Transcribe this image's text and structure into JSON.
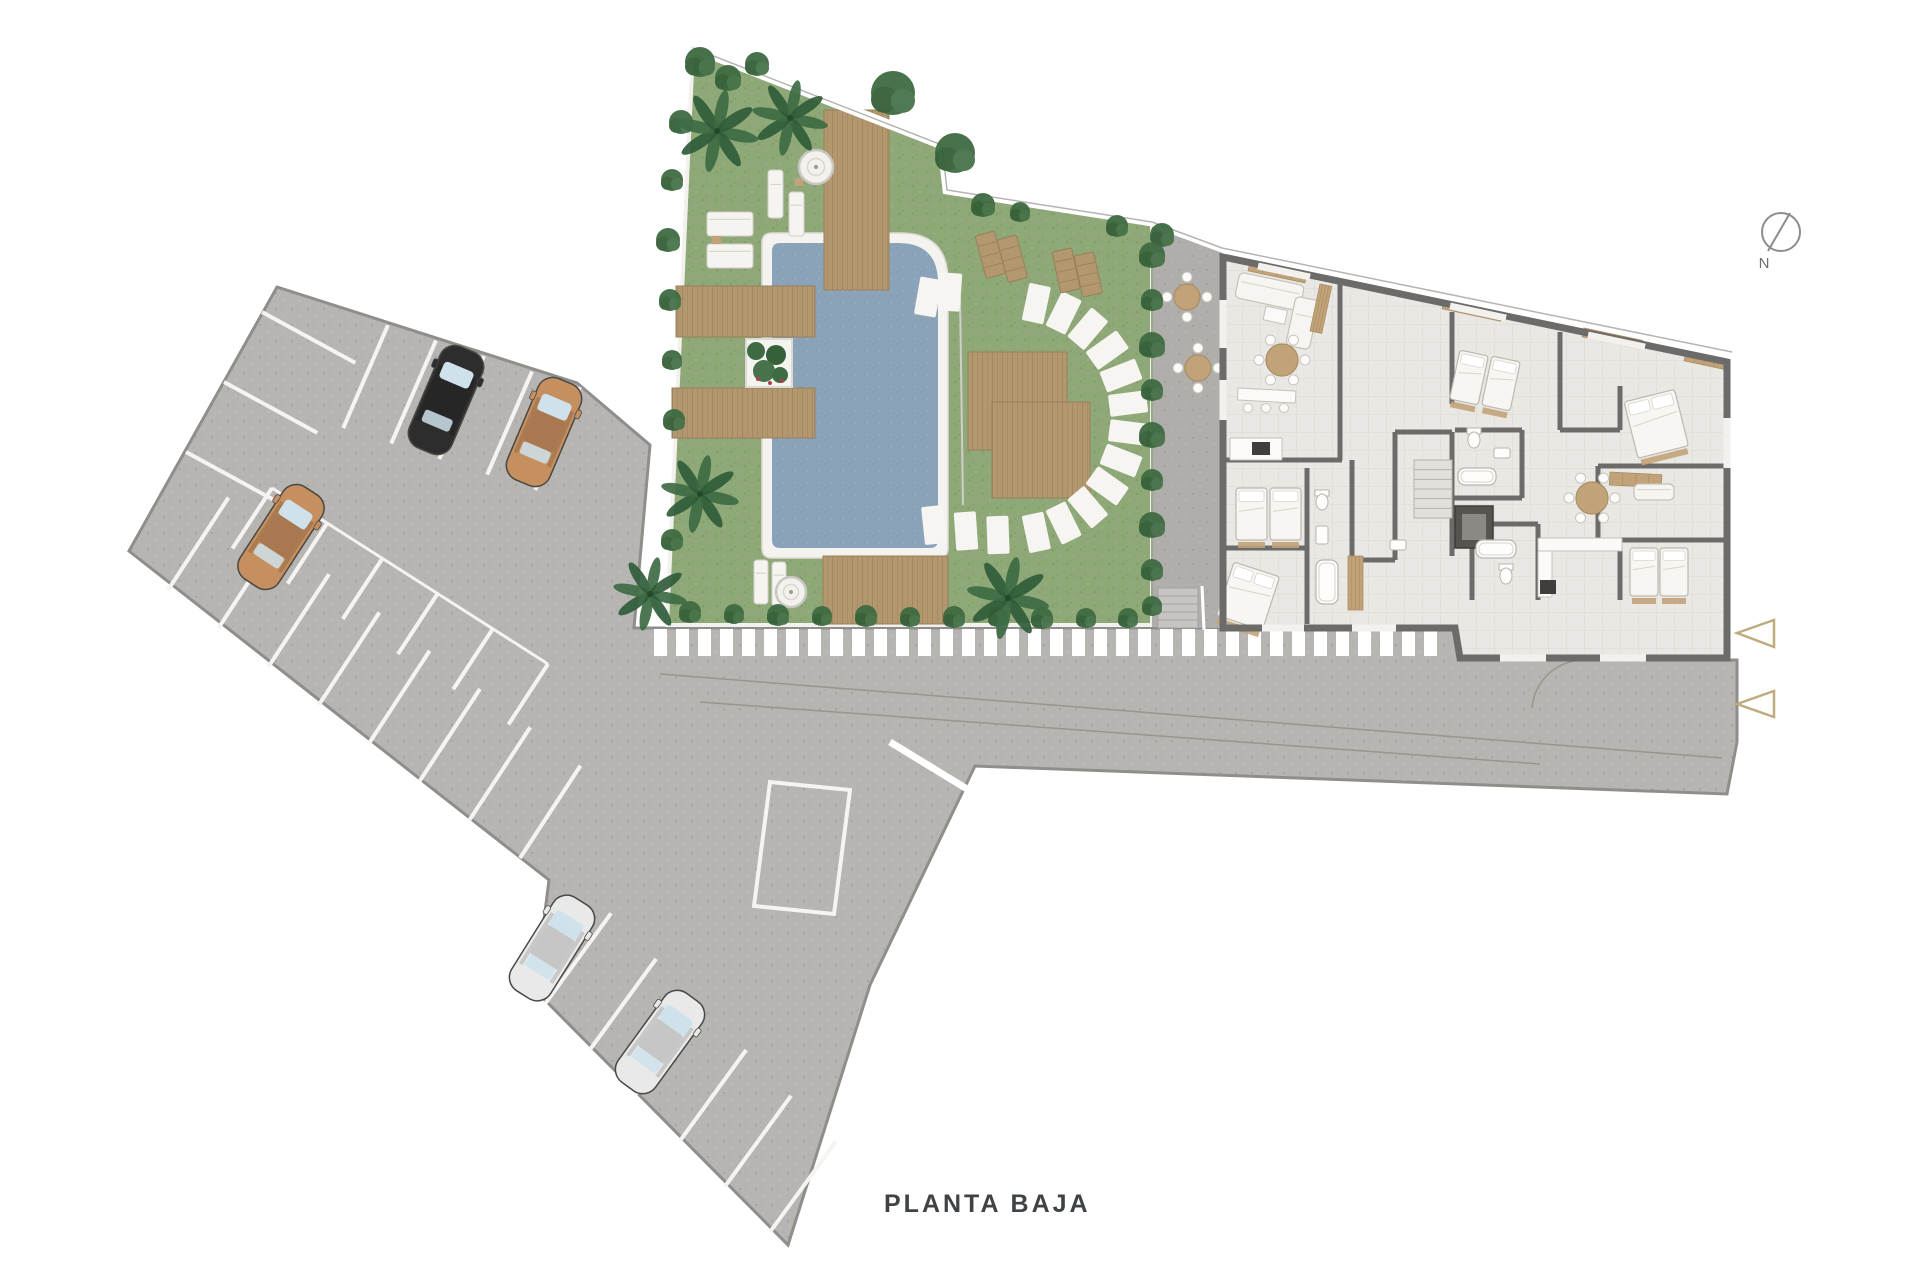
{
  "title": {
    "text": "PLANTA BAJA"
  },
  "compass": {
    "label": "N"
  },
  "palette": {
    "bg": "#ffffff",
    "pavement": "#b6b5b2",
    "pavement_dark": "#afaeab",
    "grass": "#8fa878",
    "bush": "#3f6b42",
    "wood": "#b3976e",
    "wood_line": "#97805a",
    "water": "#8aa3b8",
    "wall": "#6c6b69",
    "floor": "#e9e8e4",
    "floor_line": "#dbd9d2",
    "fixture": "#f7f6f3",
    "tan": "#c2a379",
    "accent": "#bfab7e",
    "text": "#3f4345",
    "stall": "#f5f4f1",
    "road_line": "#97968f",
    "glass": "#cfe2ec",
    "lot_edge": "#8f8e8b",
    "black_car": "#2d2d2d",
    "tan_car": "#c68f5f",
    "white_car": "#e9e9ea"
  },
  "parking": {
    "cars": [
      {
        "x": 446,
        "y": 400,
        "rot": 23,
        "color": "black_car"
      },
      {
        "x": 544,
        "y": 432,
        "rot": 23,
        "color": "tan_car"
      },
      {
        "x": 281,
        "y": 537,
        "rot": 33,
        "color": "tan_car"
      },
      {
        "x": 552,
        "y": 948,
        "rot": 32,
        "color": "white_car"
      },
      {
        "x": 660,
        "y": 1042,
        "rot": 36,
        "color": "white_car"
      }
    ],
    "stall_rows": [
      {
        "a": [
          388,
          325
        ],
        "b": [
          580,
          387
        ],
        "count": 5,
        "dir": [
          -0.4,
          0.92
        ],
        "len": 112
      },
      {
        "a": [
          262,
          312
        ],
        "b": [
          186,
          452
        ],
        "count": 3,
        "dir": [
          0.88,
          0.48
        ],
        "len": 106
      },
      {
        "a": [
          168,
          590
        ],
        "b": [
          520,
          858
        ],
        "count": 8,
        "dir": [
          0.55,
          -0.84
        ],
        "len": 110
      },
      {
        "a": [
          545,
          1004
        ],
        "b": [
          770,
          1232
        ],
        "count": 6,
        "dir": [
          0.59,
          -0.81
        ],
        "len": 112
      },
      {
        "a": [
          272,
          488
        ],
        "b": [
          548,
          664
        ],
        "count": 6,
        "dir": [
          -0.55,
          0.84
        ],
        "len": 72
      }
    ],
    "spine_rail": {
      "x1": 272,
      "y1": 488,
      "x2": 548,
      "y2": 664
    },
    "ramp_marking": "770,782 850,790 834,914 754,906"
  },
  "crosswalk": {
    "from": 654,
    "to": 1446,
    "y": 629,
    "h": 27,
    "w": 13,
    "gap": 9
  },
  "entrance_arrows": [
    "1737,633 1774,620 1774,647",
    "1737,704 1774,691 1774,717"
  ],
  "garden": {
    "palms": [
      {
        "x": 717,
        "y": 131,
        "r": 38
      },
      {
        "x": 790,
        "y": 118,
        "r": 35
      },
      {
        "x": 700,
        "y": 494,
        "r": 36
      },
      {
        "x": 650,
        "y": 594,
        "r": 34
      },
      {
        "x": 1008,
        "y": 598,
        "r": 38
      }
    ],
    "bushes": [
      {
        "x": 700,
        "y": 62,
        "r": 15
      },
      {
        "x": 728,
        "y": 78,
        "r": 13
      },
      {
        "x": 757,
        "y": 64,
        "r": 12
      },
      {
        "x": 681,
        "y": 122,
        "r": 12
      },
      {
        "x": 672,
        "y": 180,
        "r": 11
      },
      {
        "x": 668,
        "y": 240,
        "r": 12
      },
      {
        "x": 670,
        "y": 300,
        "r": 11
      },
      {
        "x": 672,
        "y": 360,
        "r": 10
      },
      {
        "x": 674,
        "y": 420,
        "r": 11
      },
      {
        "x": 672,
        "y": 540,
        "r": 11
      },
      {
        "x": 893,
        "y": 93,
        "r": 22
      },
      {
        "x": 955,
        "y": 153,
        "r": 20
      },
      {
        "x": 983,
        "y": 205,
        "r": 12
      },
      {
        "x": 1020,
        "y": 212,
        "r": 10
      },
      {
        "x": 1117,
        "y": 226,
        "r": 11
      },
      {
        "x": 1162,
        "y": 235,
        "r": 12
      },
      {
        "x": 690,
        "y": 612,
        "r": 11
      },
      {
        "x": 734,
        "y": 614,
        "r": 10
      },
      {
        "x": 778,
        "y": 615,
        "r": 11
      },
      {
        "x": 822,
        "y": 616,
        "r": 10
      },
      {
        "x": 866,
        "y": 616,
        "r": 11
      },
      {
        "x": 910,
        "y": 617,
        "r": 10
      },
      {
        "x": 954,
        "y": 617,
        "r": 11
      },
      {
        "x": 998,
        "y": 617,
        "r": 10
      },
      {
        "x": 1042,
        "y": 618,
        "r": 11
      },
      {
        "x": 1086,
        "y": 618,
        "r": 10
      },
      {
        "x": 1128,
        "y": 618,
        "r": 10
      },
      {
        "x": 1152,
        "y": 255,
        "r": 13
      },
      {
        "x": 1152,
        "y": 300,
        "r": 11
      },
      {
        "x": 1152,
        "y": 345,
        "r": 13
      },
      {
        "x": 1152,
        "y": 390,
        "r": 11
      },
      {
        "x": 1152,
        "y": 435,
        "r": 13
      },
      {
        "x": 1152,
        "y": 480,
        "r": 11
      },
      {
        "x": 1152,
        "y": 525,
        "r": 13
      },
      {
        "x": 1152,
        "y": 570,
        "r": 11
      },
      {
        "x": 1152,
        "y": 606,
        "r": 10
      }
    ],
    "decks": [
      {
        "x": 824,
        "y": 110,
        "w": 65,
        "h": 180
      },
      {
        "x": 676,
        "y": 286,
        "w": 139,
        "h": 51
      },
      {
        "x": 672,
        "y": 388,
        "w": 143,
        "h": 50
      },
      {
        "x": 968,
        "y": 352,
        "w": 99,
        "h": 98
      },
      {
        "x": 992,
        "y": 402,
        "w": 98,
        "h": 96
      },
      {
        "x": 823,
        "y": 556,
        "w": 125,
        "h": 68
      }
    ],
    "planter": {
      "x": 746,
      "y": 339,
      "w": 46,
      "h": 48
    },
    "white_loungers": [
      {
        "x": 707,
        "y": 212,
        "w": 46,
        "h": 24,
        "rot": 0
      },
      {
        "x": 707,
        "y": 244,
        "w": 46,
        "h": 24,
        "rot": 0
      },
      {
        "x": 768,
        "y": 170,
        "w": 15,
        "h": 48,
        "rot": 0
      },
      {
        "x": 789,
        "y": 192,
        "w": 15,
        "h": 44,
        "rot": 0
      },
      {
        "x": 754,
        "y": 560,
        "w": 14,
        "h": 44,
        "rot": 0
      },
      {
        "x": 772,
        "y": 562,
        "w": 14,
        "h": 44,
        "rot": 0
      }
    ],
    "wood_loungers": [
      {
        "x": 975,
        "y": 236,
        "w": 20,
        "h": 44,
        "rot": -15
      },
      {
        "x": 997,
        "y": 240,
        "w": 20,
        "h": 44,
        "rot": -15
      },
      {
        "x": 1052,
        "y": 252,
        "w": 20,
        "h": 42,
        "rot": -12
      },
      {
        "x": 1074,
        "y": 256,
        "w": 20,
        "h": 42,
        "rot": -12
      }
    ],
    "side_tables": [
      {
        "x": 712,
        "y": 236,
        "w": 9,
        "h": 8
      },
      {
        "x": 795,
        "y": 178,
        "w": 8,
        "h": 8
      }
    ],
    "jacuzzis": [
      {
        "x": 816,
        "y": 167,
        "r": 17
      },
      {
        "x": 791,
        "y": 592,
        "r": 15
      }
    ],
    "stone_arc": {
      "cx": 1012,
      "cy": 418,
      "r": 117,
      "start": -78,
      "end": 78,
      "count": 12,
      "w": 22,
      "h": 38
    },
    "extra_stones": [
      {
        "x": 928,
        "y": 297,
        "rot": 10
      },
      {
        "x": 950,
        "y": 292,
        "rot": 4
      },
      {
        "x": 934,
        "y": 525,
        "rot": -6
      },
      {
        "x": 966,
        "y": 531,
        "rot": -4
      },
      {
        "x": 998,
        "y": 535,
        "rot": -2
      }
    ]
  },
  "terrace": {
    "tables": [
      {
        "x": 1187,
        "y": 297,
        "r": 13
      },
      {
        "x": 1198,
        "y": 368,
        "r": 13
      }
    ],
    "stairs": {
      "x": 1158,
      "y": 588,
      "w": 40,
      "h": 40,
      "steps": 5
    }
  },
  "building": {
    "furniture": [
      {
        "t": "sofa",
        "x": 1240,
        "y": 272,
        "w": 66,
        "h": 26,
        "rot": 12
      },
      {
        "t": "sofa",
        "x": 1296,
        "y": 296,
        "w": 24,
        "h": 50,
        "rot": 12
      },
      {
        "t": "counter",
        "x": 1266,
        "y": 306,
        "w": 22,
        "h": 14,
        "rot": 12
      },
      {
        "t": "wardrobe",
        "x": 1320,
        "y": 284,
        "w": 12,
        "h": 48,
        "rot": 12
      },
      {
        "t": "rtable",
        "x": 1282,
        "y": 360,
        "r": 16
      },
      {
        "t": "counter",
        "x": 1238,
        "y": 388,
        "w": 58,
        "h": 12,
        "rot": 3
      },
      {
        "t": "stools",
        "x": 1248,
        "y": 408
      },
      {
        "t": "counter",
        "x": 1230,
        "y": 438,
        "w": 52,
        "h": 22,
        "rot": 0
      },
      {
        "t": "stove",
        "x": 1252,
        "y": 442,
        "w": 18,
        "h": 13
      },
      {
        "t": "bed",
        "x": 1236,
        "y": 488,
        "w": 31,
        "h": 52,
        "rot": 0
      },
      {
        "t": "bed",
        "x": 1270,
        "y": 488,
        "w": 31,
        "h": 52,
        "rot": 0
      },
      {
        "t": "bed",
        "x": 1234,
        "y": 562,
        "w": 48,
        "h": 56,
        "rot": 18,
        "double": true
      },
      {
        "t": "wc",
        "x": 1322,
        "y": 502
      },
      {
        "t": "sink",
        "x": 1316,
        "y": 526,
        "w": 12,
        "h": 18
      },
      {
        "t": "tub",
        "x": 1316,
        "y": 560,
        "w": 22,
        "h": 44
      },
      {
        "t": "bed",
        "x": 1460,
        "y": 350,
        "w": 29,
        "h": 50,
        "rot": 12
      },
      {
        "t": "bed",
        "x": 1492,
        "y": 356,
        "w": 29,
        "h": 50,
        "rot": 12
      },
      {
        "t": "wc",
        "x": 1474,
        "y": 440
      },
      {
        "t": "sink",
        "x": 1494,
        "y": 448,
        "w": 16,
        "h": 10
      },
      {
        "t": "tub",
        "x": 1458,
        "y": 468,
        "w": 38,
        "h": 17
      },
      {
        "t": "elevator",
        "x": 1455,
        "y": 506,
        "w": 38,
        "h": 42
      },
      {
        "t": "stairs",
        "x": 1414,
        "y": 460,
        "w": 38,
        "h": 58
      },
      {
        "t": "bed",
        "x": 1624,
        "y": 402,
        "w": 52,
        "h": 58,
        "rot": -14,
        "double": true
      },
      {
        "t": "wardrobe",
        "x": 1610,
        "y": 472,
        "w": 52,
        "h": 13,
        "rot": 3
      },
      {
        "t": "rtable",
        "x": 1592,
        "y": 498,
        "r": 16
      },
      {
        "t": "sofa",
        "x": 1634,
        "y": 484,
        "w": 40,
        "h": 16,
        "rot": 0
      },
      {
        "t": "counter",
        "x": 1538,
        "y": 538,
        "w": 84,
        "h": 13,
        "rot": 0
      },
      {
        "t": "counter",
        "x": 1538,
        "y": 551,
        "w": 14,
        "h": 46,
        "rot": 0
      },
      {
        "t": "stove",
        "x": 1540,
        "y": 580,
        "w": 16,
        "h": 14
      },
      {
        "t": "bed",
        "x": 1630,
        "y": 548,
        "w": 28,
        "h": 48,
        "rot": 0
      },
      {
        "t": "bed",
        "x": 1660,
        "y": 548,
        "w": 28,
        "h": 48,
        "rot": 0
      },
      {
        "t": "tub",
        "x": 1476,
        "y": 540,
        "w": 40,
        "h": 18
      },
      {
        "t": "wc",
        "x": 1506,
        "y": 576
      },
      {
        "t": "wardrobe",
        "x": 1348,
        "y": 556,
        "w": 15,
        "h": 54,
        "rot": 0
      },
      {
        "t": "sink",
        "x": 1390,
        "y": 540,
        "w": 16,
        "h": 10
      },
      {
        "t": "wsill",
        "x": 1250,
        "y": 262,
        "w": 58,
        "h": 9,
        "rot": 12
      },
      {
        "t": "wsill",
        "x": 1444,
        "y": 300,
        "w": 60,
        "h": 9,
        "rot": 12
      },
      {
        "t": "wsill",
        "x": 1584,
        "y": 328,
        "w": 60,
        "h": 9,
        "rot": 12
      },
      {
        "t": "wsill",
        "x": 1686,
        "y": 352,
        "w": 40,
        "h": 9,
        "rot": 12
      }
    ]
  }
}
